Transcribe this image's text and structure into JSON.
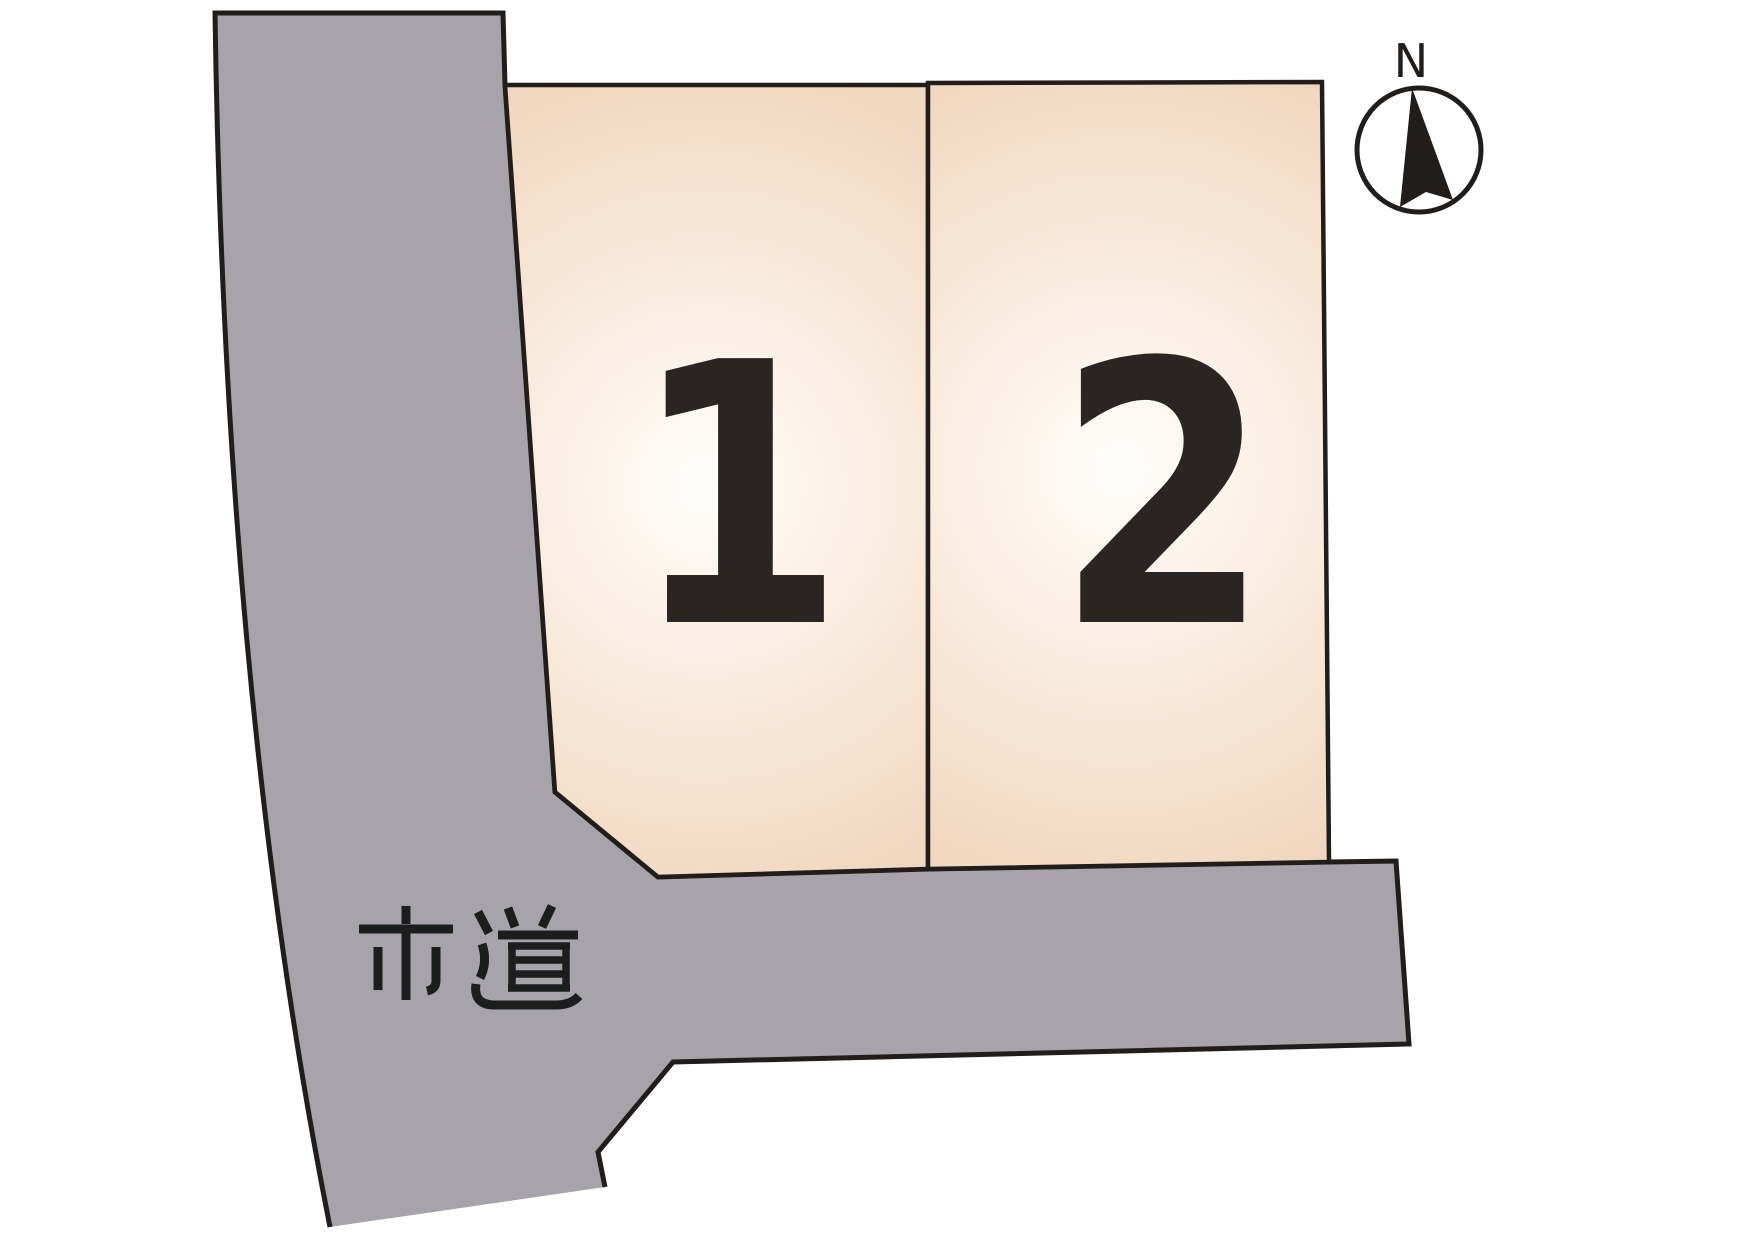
{
  "diagram": {
    "lots": [
      {
        "number": "1"
      },
      {
        "number": "2"
      }
    ],
    "road": {
      "label": "市道"
    },
    "compass": {
      "label": "N"
    },
    "colors": {
      "background": "#ffffff",
      "road_fill": "#a7a3ab",
      "outline": "#201d1b",
      "lot_center": "#fffefc",
      "lot_mid": "#f9ecdf",
      "lot_edge": "#f1d7bf",
      "lot_number": "#2a2522",
      "road_label": "#1c1e1d",
      "compass_fill": "#ffffff"
    }
  }
}
